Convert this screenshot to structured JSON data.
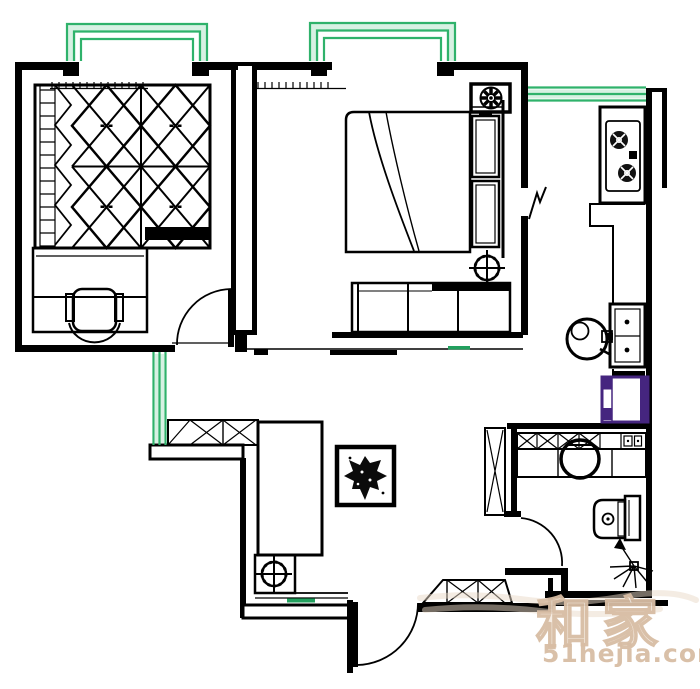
{
  "watermark": {
    "brand": "和家",
    "site": "51hejia.com"
  },
  "colors": {
    "wall-black": "#000000",
    "window-green": "#2fb26b",
    "window-green-light": "#c9ecd9",
    "floor-mark-green": "#22a05e",
    "appliance-purple": "#45257f",
    "watermark-tan": "#d8bda4",
    "watermark-tan-light": "#ead9c8"
  }
}
